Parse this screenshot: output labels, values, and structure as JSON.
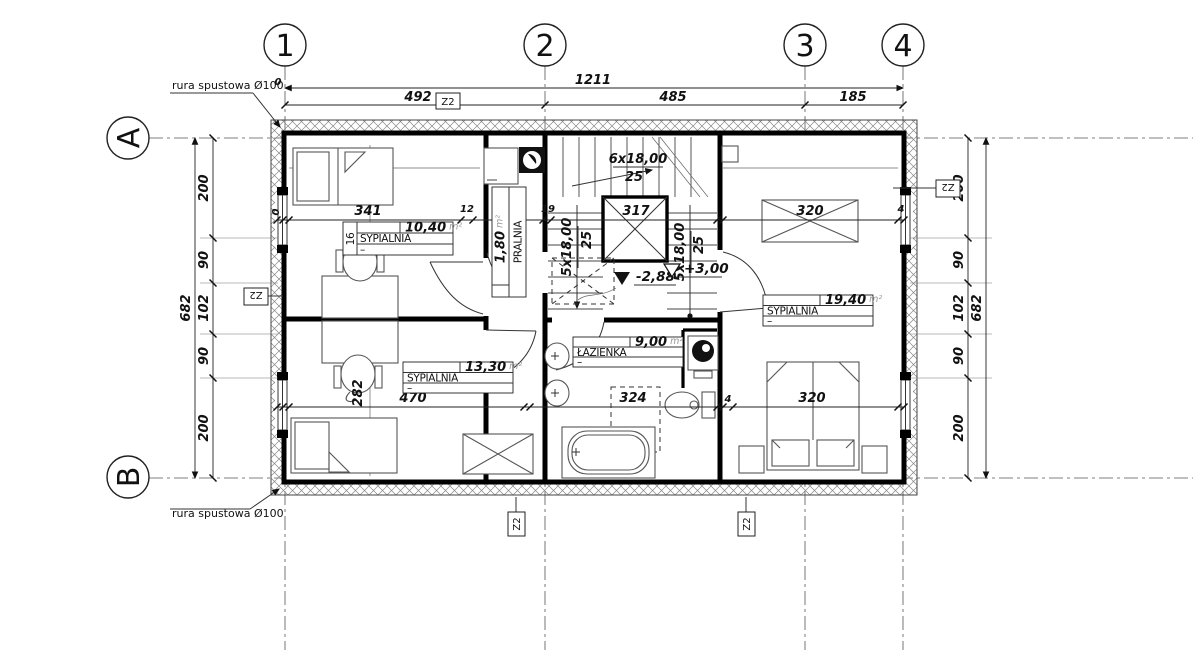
{
  "axes": {
    "c1": "1",
    "c2": "2",
    "c3": "3",
    "c4": "4",
    "rA": "A",
    "rB": "B"
  },
  "dims": {
    "zero": "0",
    "total": "1211",
    "s12": "492",
    "s23": "485",
    "s34": "185",
    "side": [
      "200",
      "90",
      "102",
      "90",
      "200"
    ],
    "side_total": "682",
    "mid": {
      "zero": "0",
      "a": "341",
      "b": "12",
      "c": "117",
      "d": "19",
      "e": "317",
      "f": "320",
      "g": "4"
    },
    "low": {
      "a": "470",
      "b": "324",
      "c": "4",
      "d": "320",
      "depth": "282"
    }
  },
  "stairs": {
    "up": "6x18,00",
    "up2": "25",
    "l": "5x18,00",
    "l2": "25",
    "r": "5x18,00",
    "r2": "25"
  },
  "levels": {
    "down": "-2,88",
    "up": "+3,00"
  },
  "z2": "Z2",
  "downpipe": "rura spustowa Ø100",
  "rooms": {
    "nw": {
      "no": "16",
      "name": "SYPIALNIA",
      "area": "10,40",
      "unit": "m²",
      "note": "–"
    },
    "laundry": {
      "name": "PRALNIA",
      "area": "1,80",
      "unit": "m²"
    },
    "sw": {
      "name": "SYPIALNIA",
      "area": "13,30",
      "unit": "m²",
      "note": "–"
    },
    "bath": {
      "name": "ŁAZIENKA",
      "area": "9,00",
      "unit": "m²",
      "note": "–"
    },
    "east": {
      "name": "SYPIALNIA",
      "area": "19,40",
      "unit": "m²",
      "note": "–"
    }
  }
}
